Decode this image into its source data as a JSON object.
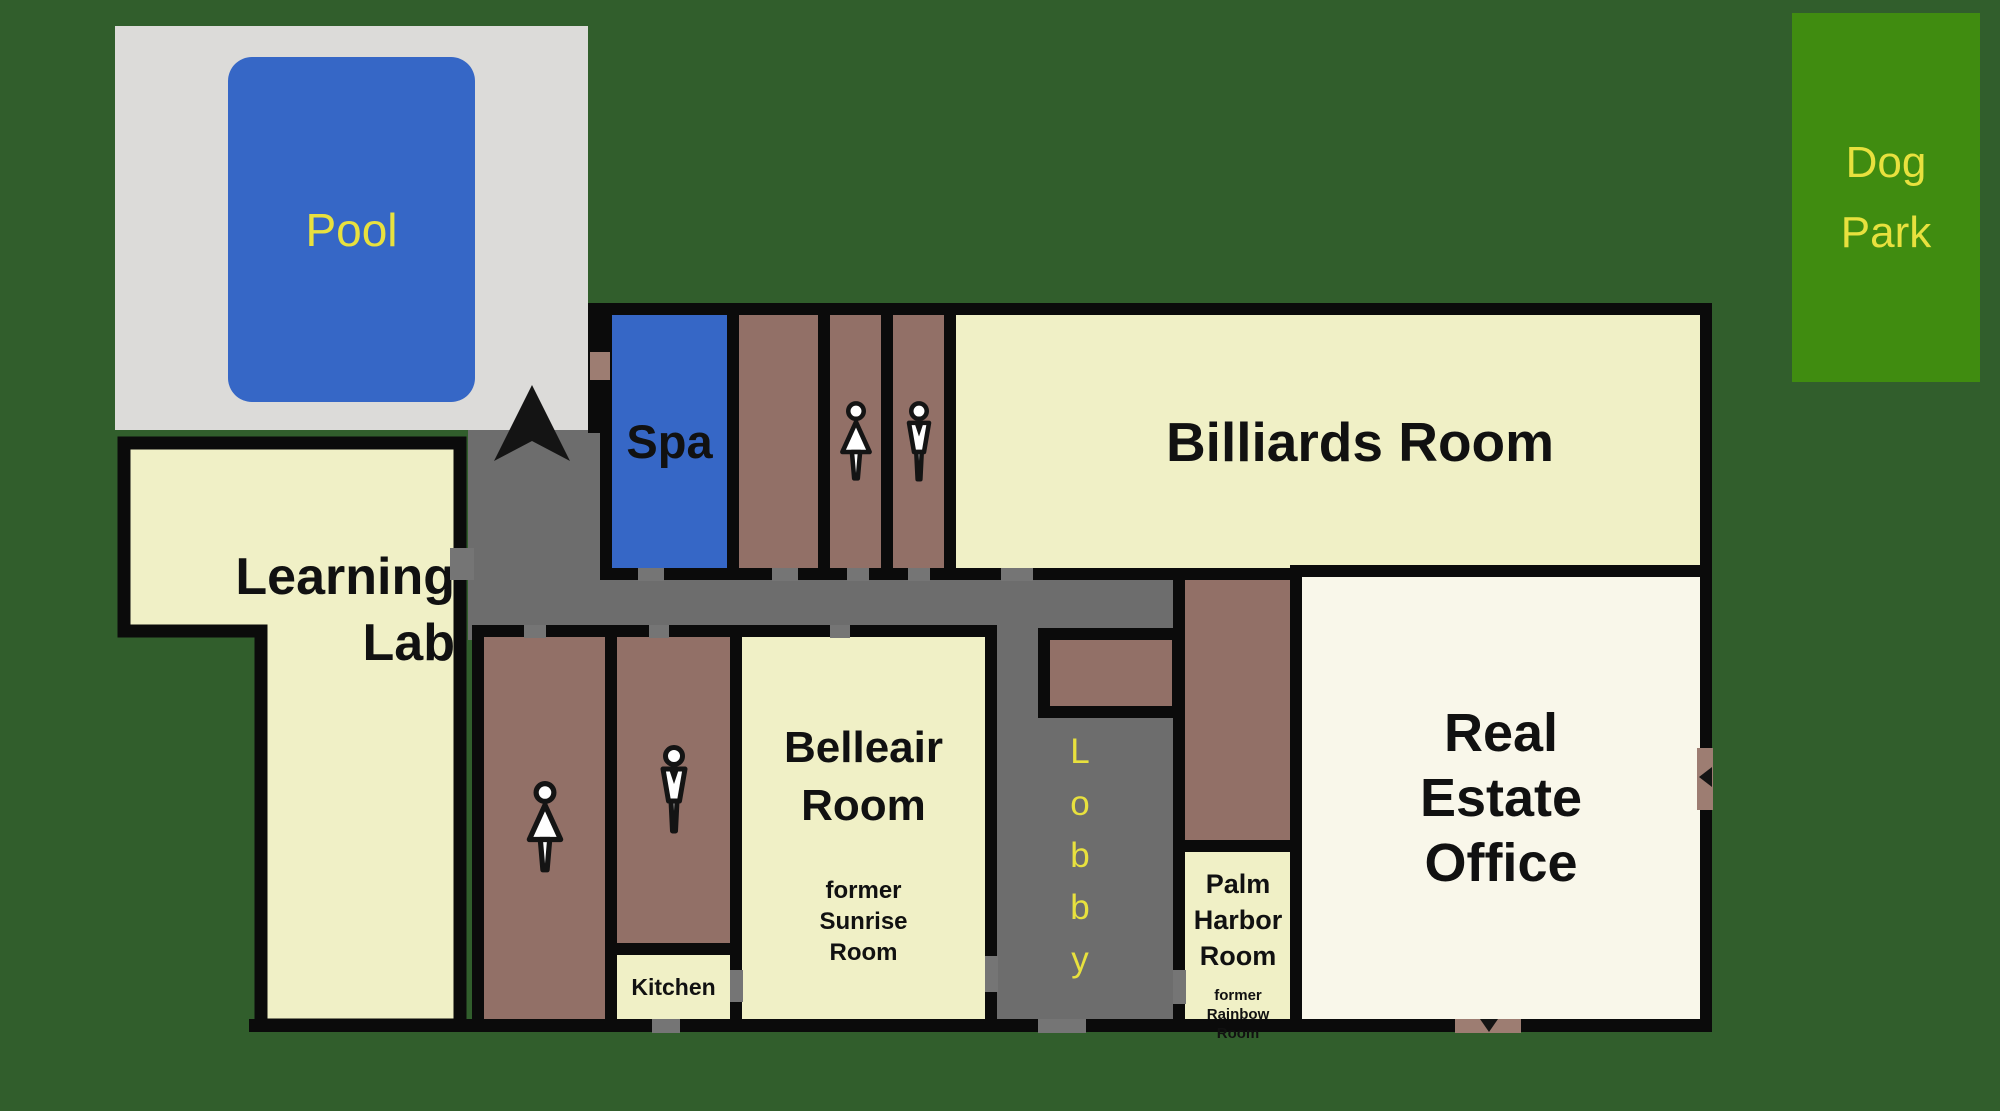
{
  "colors": {
    "background_green": "#315e2c",
    "dog_park_green": "#408c10",
    "label_yellow": "#e8e13e",
    "room_cream": "#f0f0c6",
    "office_cream": "#f9f7ea",
    "restroom_brown": "#927067",
    "door_brown": "#9d7d72",
    "corridor_gray": "#6d6d6d",
    "pool_deck_gray": "#dcdbd9",
    "water_blue": "#3667c6",
    "wall_black": "#0b0b0b"
  },
  "outdoor": {
    "pool": {
      "label": "Pool"
    },
    "dog_park": {
      "label": "Dog\nPark"
    }
  },
  "rooms": {
    "spa": {
      "label": "Spa"
    },
    "billiards": {
      "label": "Billiards Room"
    },
    "learning_lab": {
      "label": "Learning\nLab"
    },
    "belleair": {
      "label": "Belleair\nRoom",
      "former": "former\nSunrise\nRoom"
    },
    "kitchen": {
      "label": "Kitchen"
    },
    "palm_harbor": {
      "label": "Palm\nHarbor\nRoom",
      "former": "former\nRainbow\nRoom"
    },
    "real_estate": {
      "label": "Real\nEstate\nOffice"
    },
    "lobby": {
      "label": "Lobby",
      "label_vertical": "L\no\nb\nb\ny"
    }
  },
  "icons": {
    "north_arrow": "north-arrow",
    "womens_restroom": "female-restroom-figure",
    "mens_restroom": "male-restroom-figure"
  }
}
